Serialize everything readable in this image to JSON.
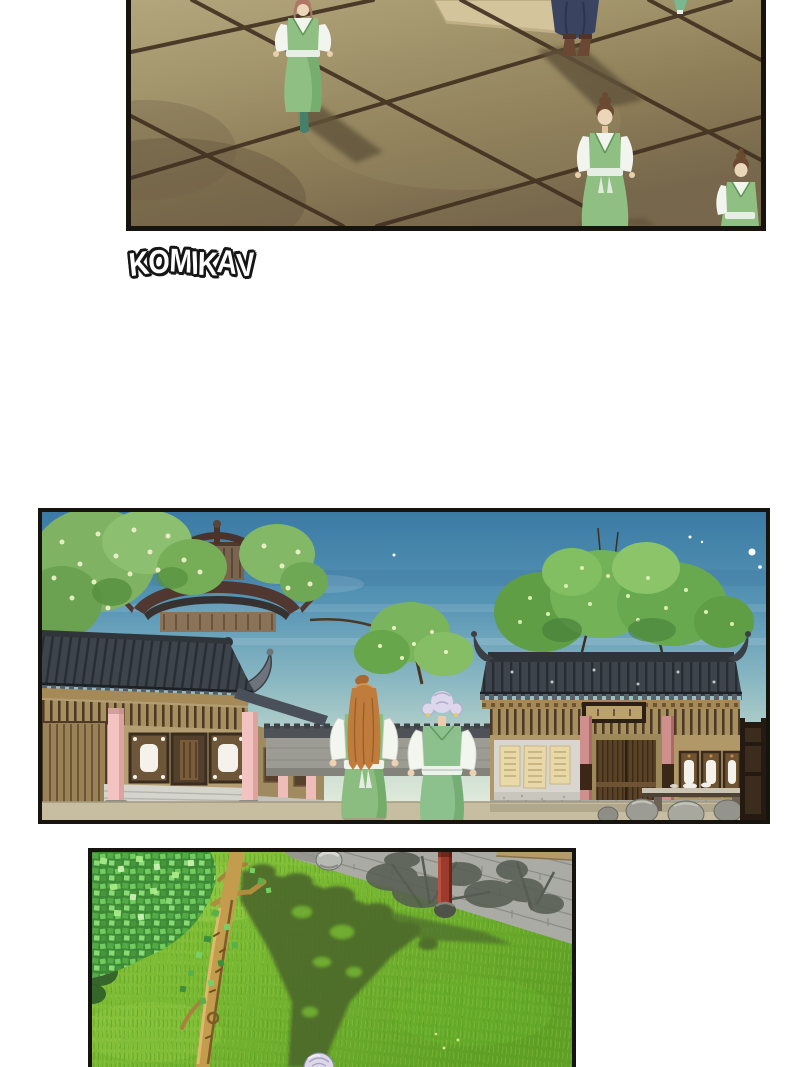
{
  "page": {
    "background": "#ffffff",
    "kind": "manhua comic page"
  },
  "watermark": {
    "text": "KOMIKAV",
    "text_color": "#ffffff",
    "outline_color": "#161616"
  },
  "panels": [
    {
      "id": "panel-courtyard",
      "description": "Overhead view of a stone-tiled courtyard; three figures in green hanfu with white sleeves, one figure in a navy robe, long shadows, a straw mat",
      "floor_color": "#9a8c64",
      "tile_line_color": "#41301f",
      "robe_green": "#8fbf82",
      "robe_navy": "#3a4460",
      "mat_color": "#d3c49c",
      "shadow_color": "#61523a"
    },
    {
      "id": "panel-street",
      "description": "Evening street with traditional halls, grey tiled roofs, pink columns, posted notices, boulders; two girls seen from behind, one with long orange hair, one with lavender side buns, both in green vests; starry teal sky",
      "sky_top": "#3b7aa4",
      "sky_bottom": "#eaf0e0",
      "roof_color": "#3d444c",
      "column_pink": "#f2c3c0",
      "vest_green": "#8cc08c",
      "hair_orange": "#bf7c3c",
      "hair_lavender": "#ddd7eb",
      "notice_color": "#ead9a8"
    },
    {
      "id": "panel-garden",
      "description": "Grass courtyard with slender tree, mosaic green foliage, grey brick wall with a red post, dappled tree shadow; top of a lavender-haired head at the bottom edge",
      "grass_color": "#79b832",
      "wall_color": "#a9aba4",
      "post_red": "#9c3b2d",
      "trunk_color": "#c49c4e",
      "shadow_color": "#4b672b"
    }
  ]
}
